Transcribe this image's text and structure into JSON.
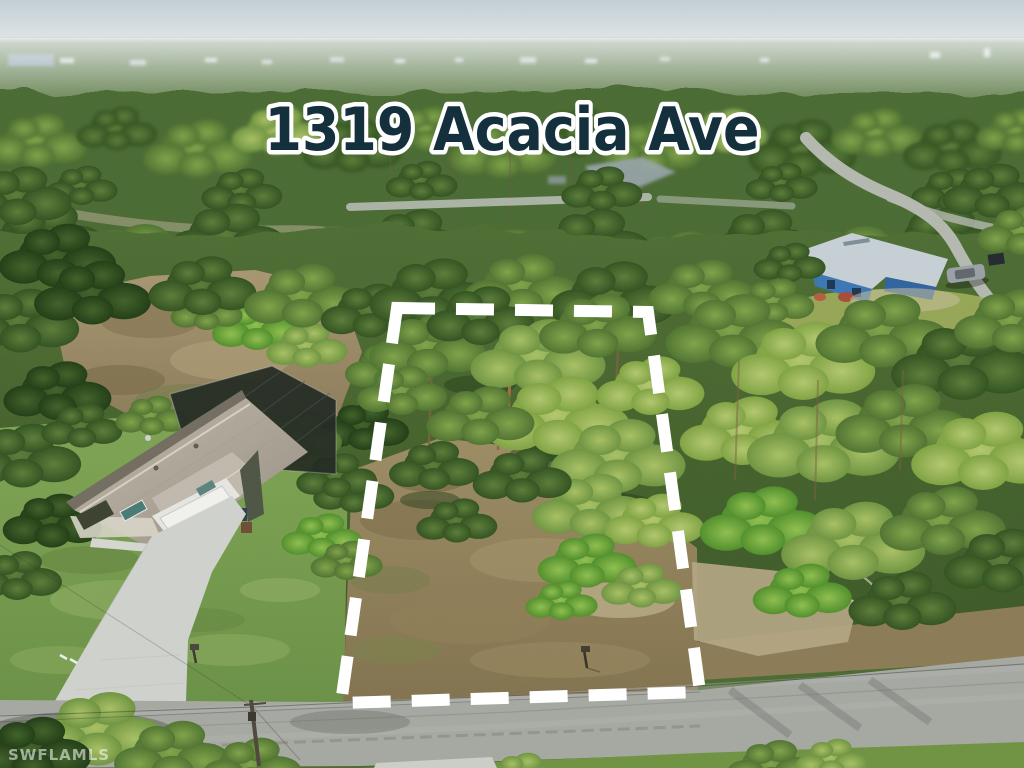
{
  "overlay": {
    "title": "1319 Acacia Ave",
    "watermark": "SWFLAMLS"
  },
  "colors": {
    "title_fill": "#14303d",
    "title_outline": "#ffffff",
    "boundary_line": "#ffffff",
    "watermark_text": "#ffffff",
    "sky_top": "#c3cfd6",
    "road_asphalt": "#a6a8a2",
    "driveway_concrete": "#d0d3cd",
    "main_house_roof": "#b2aba0",
    "pool_cage": "#20281f",
    "blue_house_wall": "#3b76b4",
    "canopy_green": "#5d8038",
    "lot_ground": "#97875f"
  }
}
